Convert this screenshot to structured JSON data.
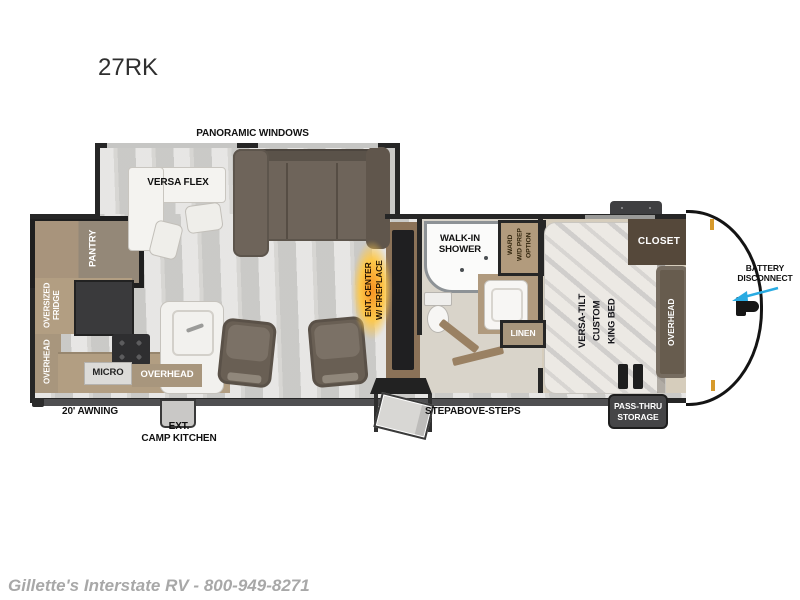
{
  "title": "27RK",
  "footer_text": "Gillette's Interstate RV - 800-949-8271",
  "colors": {
    "wall": "#262626",
    "floor_gray": "#d7d6d3",
    "cabinet_tan": "#b29e82",
    "sofa_brown": "#6e645a",
    "closet_brown": "#55483a",
    "flame_orange": "#f79021",
    "battery_arrow_cyan": "#29abe2",
    "marker_light_amber": "#d79a2b"
  },
  "labels": {
    "panoramic_windows": "PANORAMIC WINDOWS",
    "versa_flex": "VERSA FLEX",
    "pantry": "PANTRY",
    "oversized_fridge": "OVERSIZED\nFRIDGE",
    "overhead_kitchen_left": "OVERHEAD",
    "micro": "MICRO",
    "overhead_kitchen_bottom": "OVERHEAD",
    "ent_center": "ENT. CENTER\nW/ FIREPLACE",
    "walk_in_shower": "WALK-IN\nSHOWER",
    "ward_wd_prep": "WARD\nW/D PREP\nOPTION",
    "linen": "LINEN",
    "closet": "CLOSET",
    "king_bed": "VERSA-TILT\nCUSTOM\nKING BED",
    "overhead_bedroom": "OVERHEAD",
    "battery_disconnect": "BATTERY\nDISCONNECT",
    "pass_thru_storage": "PASS-THRU\nSTORAGE",
    "awning": "20' AWNING",
    "ext_camp_kitchen": "EXT.\nCAMP KITCHEN",
    "stepabove_steps": "STEPABOVE-STEPS"
  }
}
